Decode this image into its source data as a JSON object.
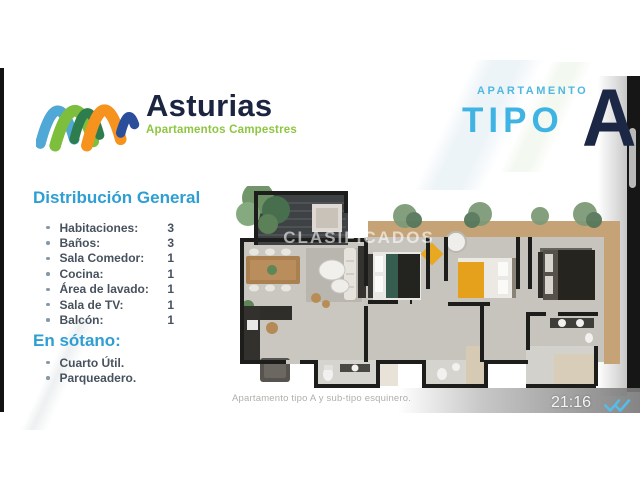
{
  "brand": {
    "name": "Asturias",
    "tagline": "Apartamentos Campestres"
  },
  "apartment": {
    "kicker": "APARTAMENTO",
    "type_word": "TIPO",
    "type_letter": "A"
  },
  "distribution": {
    "heading": "Distribución General",
    "items": [
      {
        "label": "Habitaciones:",
        "value": "3"
      },
      {
        "label": "Baños:",
        "value": "3"
      },
      {
        "label": "Sala Comedor:",
        "value": "1"
      },
      {
        "label": "Cocina:",
        "value": "1"
      },
      {
        "label": "Área de lavado:",
        "value": "1"
      },
      {
        "label": "Sala de TV:",
        "value": "1"
      },
      {
        "label": "Balcón:",
        "value": "1"
      }
    ]
  },
  "basement": {
    "heading": "En sótano:",
    "items": [
      {
        "label": "Cuarto Útil."
      },
      {
        "label": "Parqueadero."
      }
    ]
  },
  "floorplan": {
    "watermark": "CLASIFICADOS",
    "caption": "Apartamento tipo A y sub-tipo esquinero."
  },
  "message": {
    "time": "21:16"
  },
  "colors": {
    "accent_blue": "#2E9ED3",
    "navy": "#1C2745",
    "brand_green": "#8DC63F",
    "check_blue": "#53BDEB"
  }
}
